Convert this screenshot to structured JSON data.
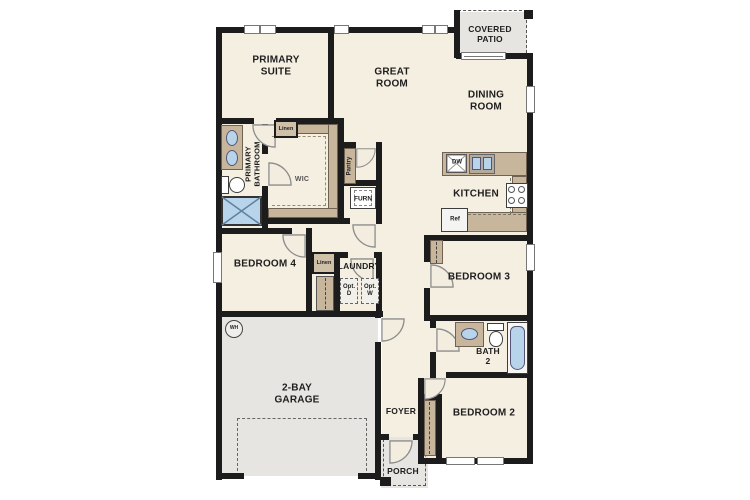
{
  "colors": {
    "floor": "#f5efe2",
    "wall": "#1c1c1c",
    "cabinetry_tan": "#c7b69c",
    "outdoor_gray": "#e6e5e2",
    "fixture_blue": "#b8d4ea",
    "background": "#ffffff"
  },
  "rooms": {
    "primary_suite": {
      "label": "PRIMARY\nSUITE"
    },
    "great_room": {
      "label": "GREAT\nROOM"
    },
    "covered_patio": {
      "label": "COVERED\nPATIO"
    },
    "dining_room": {
      "label": "DINING\nROOM"
    },
    "kitchen": {
      "label": "KITCHEN"
    },
    "primary_bathroom": {
      "label": "PRIMARY\nBATHROOM"
    },
    "wic": {
      "label": "WIC"
    },
    "pantry": {
      "label": "Pantry"
    },
    "furnace": {
      "label": "FURN"
    },
    "bedroom_4": {
      "label": "BEDROOM 4"
    },
    "laundry": {
      "label": "LAUNDRY"
    },
    "bedroom_3": {
      "label": "BEDROOM 3"
    },
    "bath_2": {
      "label": "BATH\n2"
    },
    "garage": {
      "label": "2-BAY\nGARAGE"
    },
    "foyer": {
      "label": "FOYER"
    },
    "bedroom_2": {
      "label": "BEDROOM 2"
    },
    "porch": {
      "label": "PORCH"
    }
  },
  "fixtures": {
    "linen_primary": {
      "label": "Linen"
    },
    "linen_hall": {
      "label": "Linen"
    },
    "opt_dryer": {
      "label": "Opt.\nD"
    },
    "opt_washer": {
      "label": "Opt.\nW"
    },
    "dishwasher": {
      "label": "DW"
    },
    "refrigerator": {
      "label": "Ref"
    },
    "water_heater": {
      "label": "WH"
    }
  }
}
